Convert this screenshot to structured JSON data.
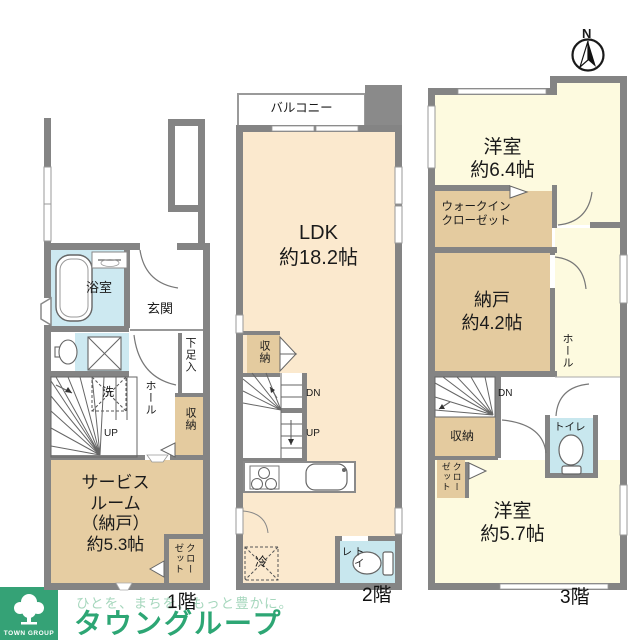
{
  "compass": {
    "north_label": "N"
  },
  "floor1": {
    "label": "1階",
    "bath": "浴室",
    "entrance": "玄関",
    "shoe_box": "下足入",
    "hall": "ホール",
    "laundry": "洗",
    "storage": "収納",
    "up": "UP",
    "service_room": "サービス\nルーム\n（納戸）\n約5.3帖",
    "closet": "クロー\nゼット"
  },
  "floor2": {
    "label": "2階",
    "balcony": "バルコニー",
    "ldk": "LDK\n約18.2帖",
    "storage": "収納",
    "dn": "DN",
    "up": "UP",
    "fridge": "冷",
    "toilet": "トイレ"
  },
  "floor3": {
    "label": "3階",
    "western_room_top": "洋室\n約6.4帖",
    "walk_in_closet": "ウォークイン\nクローゼット",
    "storage_room": "納戸\n約4.2帖",
    "hall": "ホール",
    "dn": "DN",
    "storage": "収納",
    "closet": "クロー\nゼット",
    "toilet": "トイレ",
    "western_room_bottom": "洋室\n約5.7帖"
  },
  "footer": {
    "tagline": "ひとを、まちを、もっと豊かに。",
    "brand": "タウングループ",
    "logo_text": "TOWN GROUP",
    "brand_color": "#2da674"
  },
  "colors": {
    "wall": "#848484",
    "room_cream_2f": "#fbe9ce",
    "room_cream_3f": "#fdfadf",
    "storage_tan": "#e4cb9f",
    "wet_blue": "#cde9f1"
  }
}
